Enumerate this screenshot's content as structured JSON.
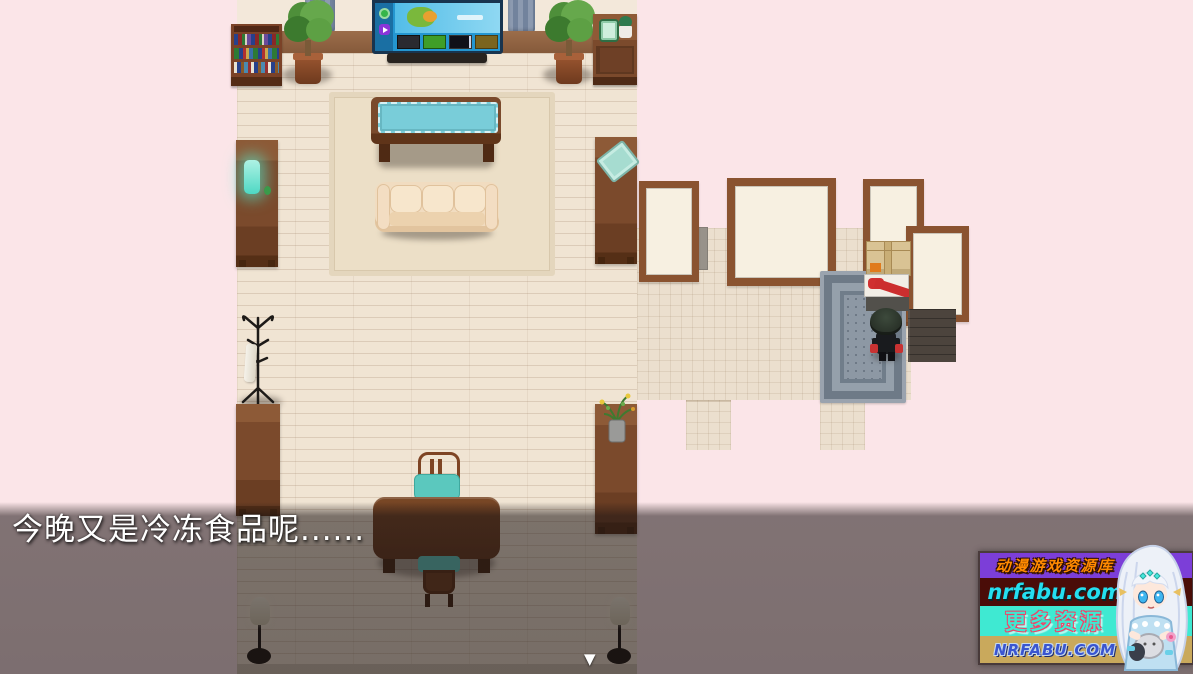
{
  "dialogue": {
    "text": "今晚又是冷冻食品呢......"
  },
  "icons": {
    "continue_arrow": "▼"
  },
  "watermark": {
    "line1": "动漫游戏资源库",
    "line2": "nrfabu.com",
    "line3": "更多资源",
    "line4": "NRFABU.COM"
  },
  "colors": {
    "letterbox_pink": "#fbe5e8",
    "floor_wood": "#f0e4d3",
    "wall_band_brown": "#916244",
    "dim_overlay": "rgba(28,20,20,0.56)",
    "table_teal": "#79cdd9",
    "entry_rug_gray": "#8d98a4",
    "watermark_purple": "#7c3ed8",
    "watermark_maroon": "#4a0d08",
    "watermark_cyan": "#3fe9d2",
    "watermark_khaki": "#c9a95c",
    "watermark_orange_text": "#ff8a00",
    "watermark_cyan_text": "#25dff0",
    "watermark_blue_text": "#3a55d0"
  }
}
